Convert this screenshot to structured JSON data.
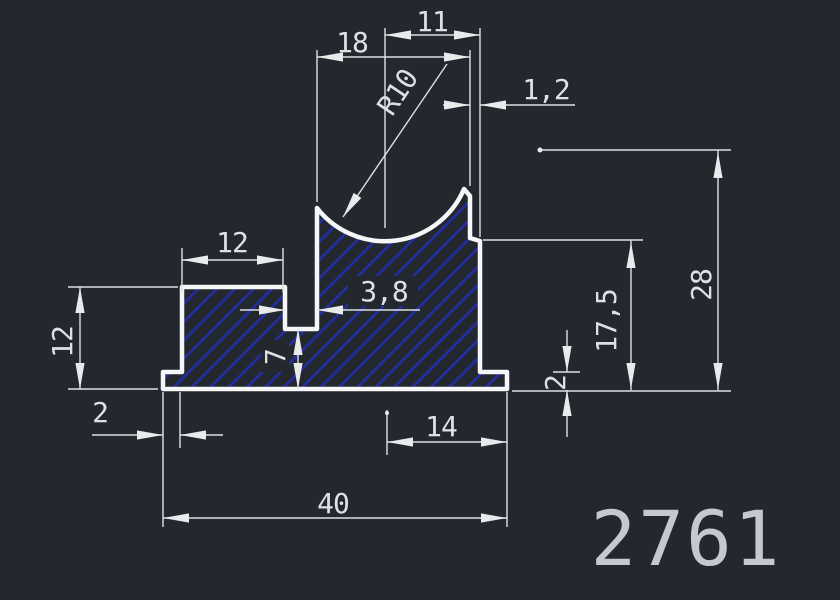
{
  "part_number": "2761",
  "colors": {
    "background": "#23272e",
    "outline": "#f4f6f8",
    "hatch": "#232d9c",
    "dimension_lines": "#dde1e4",
    "part_number_text": "#c3c9cf"
  },
  "dimensions": {
    "top_small_width": "11",
    "top_groove_width": "18",
    "groove_radius": "R10",
    "right_lip_offset": "1,2",
    "left_block_width": "12",
    "slot_width": "3,8",
    "left_block_height": "12",
    "slot_floor_thickness": "7",
    "left_foot_width": "2",
    "bottom_right_width": "14",
    "overall_width": "40",
    "base_thickness": "2",
    "right_side_height": "17,5",
    "overall_height": "28"
  }
}
